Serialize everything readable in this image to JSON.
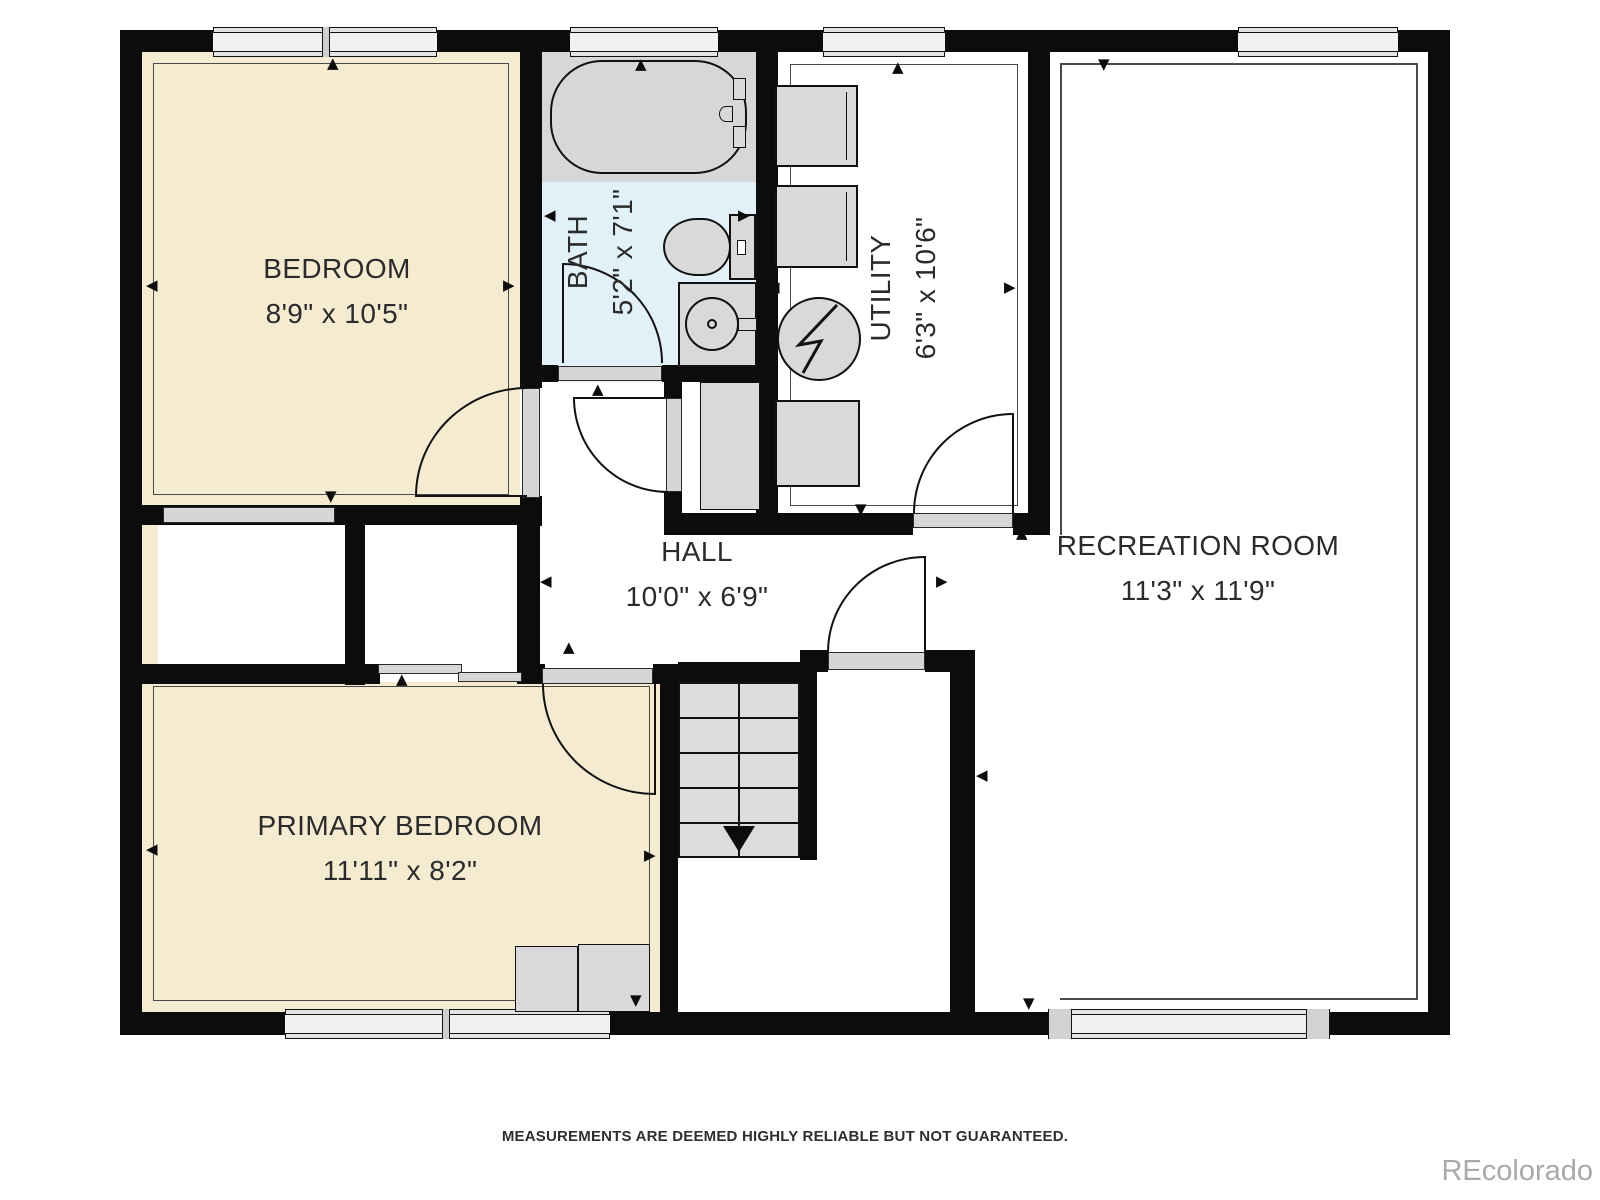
{
  "plan": {
    "rooms": {
      "bedroom": {
        "name": "BEDROOM",
        "dims": "8'9\" x 10'5\""
      },
      "bath": {
        "name": "BATH",
        "dims": "5'2\" x 7'1\""
      },
      "utility": {
        "name": "UTILITY",
        "dims": "6'3\" x 10'6\""
      },
      "hall": {
        "name": "HALL",
        "dims": "10'0\" x 6'9\""
      },
      "recreation": {
        "name": "RECREATION ROOM",
        "dims": "11'3\" x 11'9\""
      },
      "primary": {
        "name": "PRIMARY BEDROOM",
        "dims": "11'11\" x 8'2\""
      }
    },
    "icons": [
      "bathtub-icon",
      "tub-faucet-icon",
      "toilet-icon",
      "sink-icon",
      "washer-icon",
      "dryer-icon",
      "water-heater-icon",
      "lightning-icon",
      "appliance-icon",
      "furnace-icon",
      "closet-door",
      "bypass-door",
      "stairs",
      "stairs-direction-arrow",
      "dresser-icon",
      "nightstand-icon"
    ],
    "colors": {
      "wall": "#0c0c0c",
      "bedroom_floor": "#f4ebd1",
      "bath_floor": "#e2f0f8",
      "fixture_gray": "#d9d9d9",
      "step_gray": "#dcdcdc",
      "label_text": "#2b2b2b"
    }
  },
  "footer": {
    "disclaimer": "MEASUREMENTS ARE DEEMED HIGHLY RELIABLE BUT NOT GUARANTEED."
  },
  "watermark": "REcolorado"
}
